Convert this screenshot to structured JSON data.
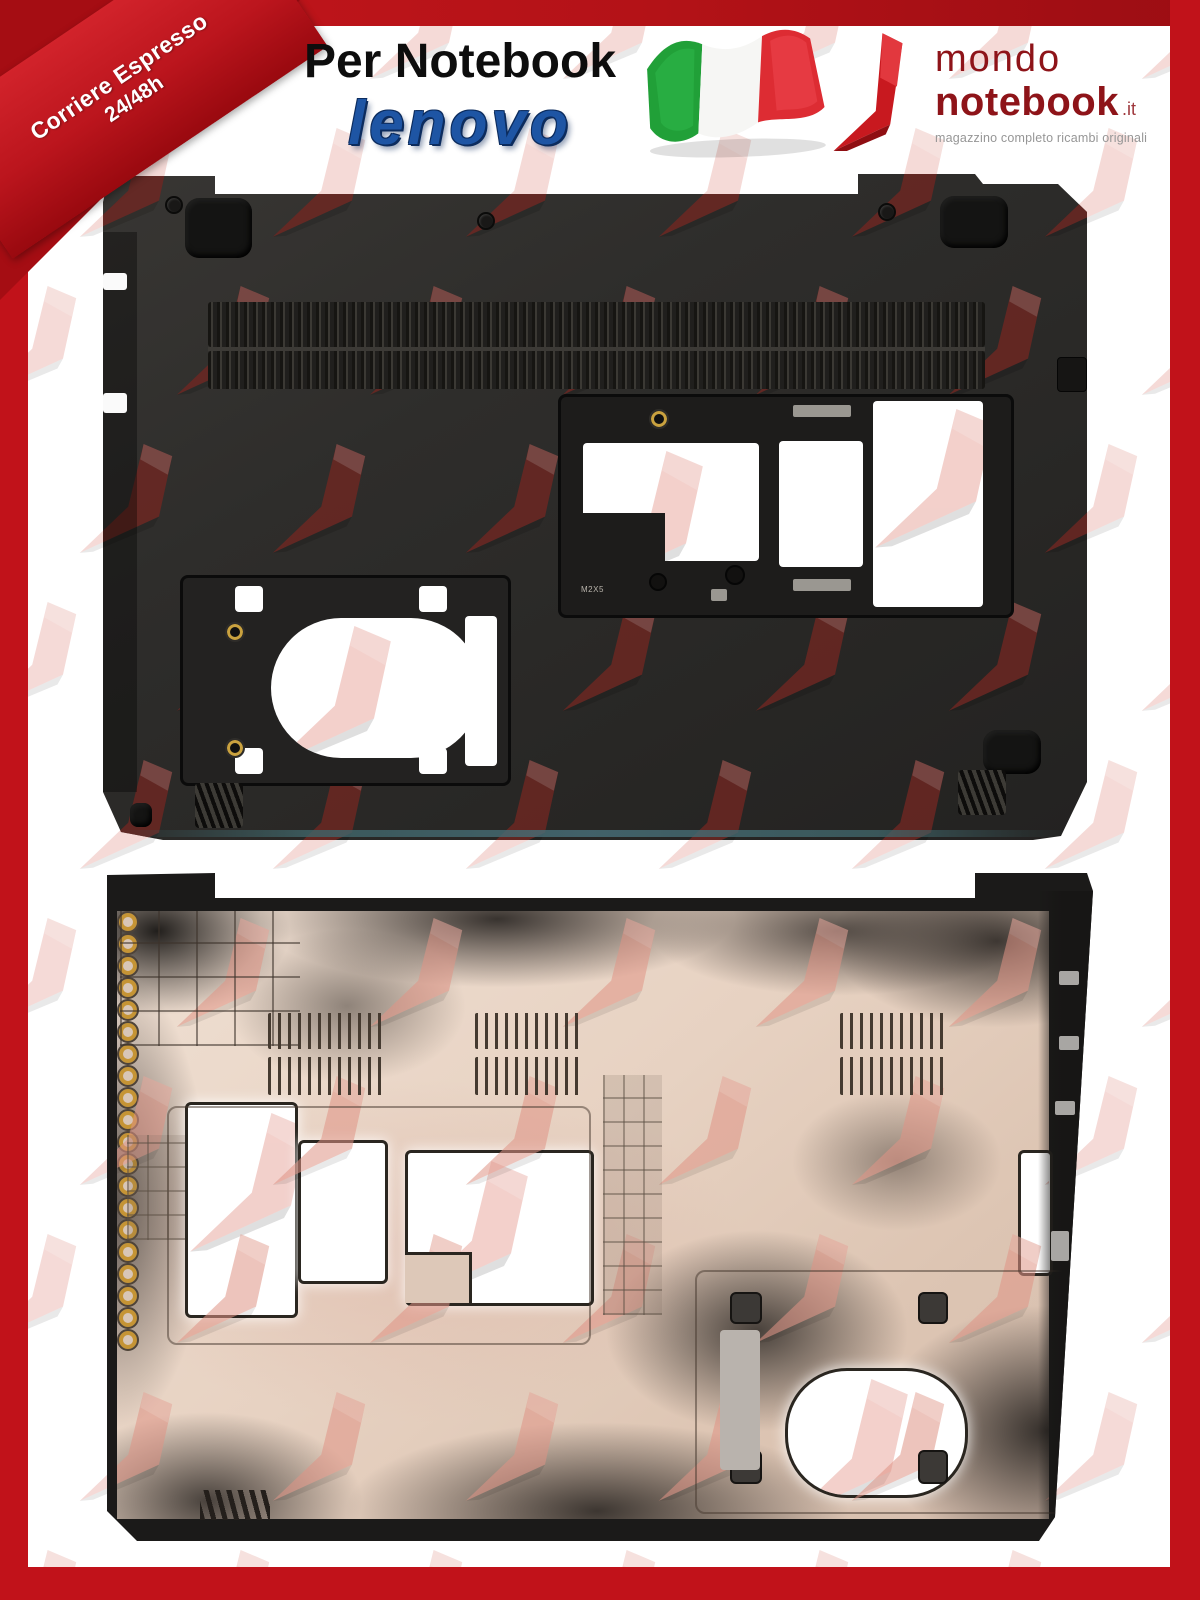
{
  "ribbon": {
    "line1": "Corriere Espresso",
    "line2": "24/48h"
  },
  "header": {
    "title": "Per Notebook",
    "brand": "lenovo"
  },
  "logo": {
    "word1": "mondo",
    "word2": "notebook",
    "tld": ".it",
    "tagline": "magazzino completo ricambi originali"
  },
  "product": {
    "screw_marking": "M2X5"
  },
  "icons": {
    "flag": "italy-flag-icon",
    "swoosh": "mondonotebook-swoosh-icon",
    "watermark": "swoosh-watermark-pattern"
  },
  "colors": {
    "frame_red": "#c1121a",
    "top_bar_red": "#ab1016",
    "ribbon_red": "#c42028",
    "lenovo_blue": "#1e55a4",
    "logo_maroon": "#8e1419",
    "tagline_gray": "#969696",
    "case_black": "#2c2b29",
    "interior_tan": "#e4d0c2",
    "watermark_pink": "#e8b7b2",
    "flag_green": "#21a038",
    "flag_white": "#f6f6f4",
    "flag_red": "#dd2c33"
  }
}
